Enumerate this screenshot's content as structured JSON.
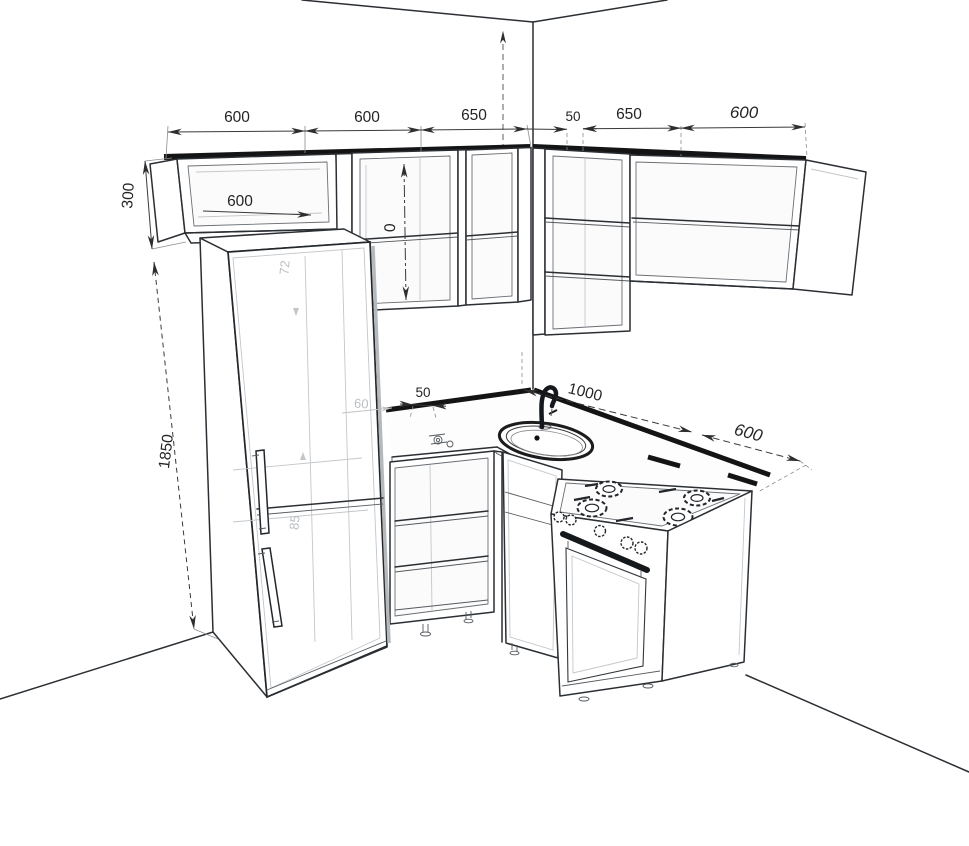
{
  "drawing": {
    "type": "kitchen-corner-3d-technical-drawing",
    "colors": {
      "line": "#2b2f33",
      "hatch_band": "#141414",
      "dimension_text": "#242424",
      "hidden_gray": "#bcbfc2",
      "background": "#ffffff"
    },
    "dims": {
      "top": [
        "600",
        "600",
        "650",
        "50",
        "650",
        "600"
      ],
      "upper_cabinet_height": "300",
      "tall_column_height": "1850",
      "upper_cabinet_inner_width": "600",
      "counter_offset": "50",
      "counter_run": "1000",
      "stove_width": "600",
      "fragments": {
        "upper_vertical_partial": "0",
        "behind_fridge_height": "72",
        "behind_fridge_width": "60",
        "base_height": "85"
      }
    }
  }
}
